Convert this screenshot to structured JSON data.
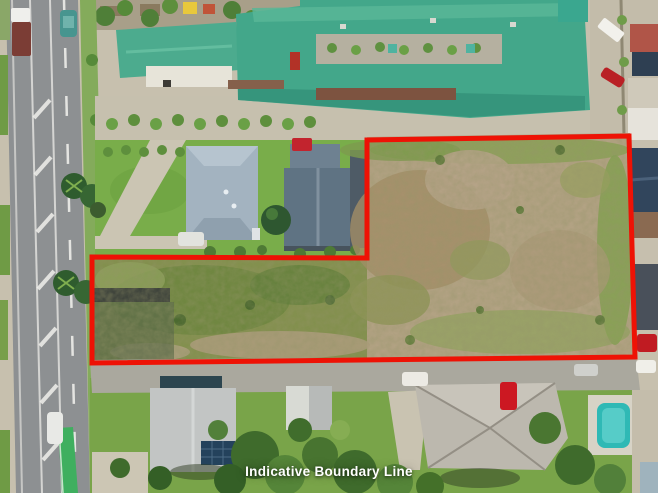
{
  "caption": {
    "text": "Indicative Boundary Line",
    "color": "#ffffff"
  },
  "boundary": {
    "label": "indicative-boundary-outline",
    "color": "#ee1205",
    "stroke_width": 5,
    "points": "367,140 629,136 635,357 92,363 92,257 367,258"
  },
  "palette": {
    "boundary_red": "#ee1205",
    "school_roof_green": "#45a88b",
    "vacant_lot_tan": "#b2a283",
    "vacant_lot_scrub_green": "#83904e",
    "lawn_green": "#79ad4a",
    "road_asphalt": "#8d9092",
    "pool_teal": "#2fb9b5",
    "house_roof_blue_gray": "#a3b3c0",
    "house_roof_dark_slate": "#5f7383"
  }
}
